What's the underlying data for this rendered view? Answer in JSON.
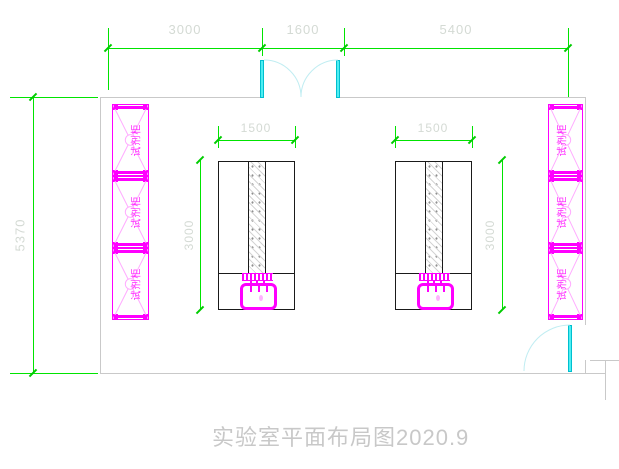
{
  "title": "实验室平面布局图2020.9",
  "dimensions": {
    "top_segments": [
      "3000",
      "1600",
      "5400"
    ],
    "room_height": "5370",
    "bench_width": "1500",
    "bench_depth": "3000"
  },
  "cabinets": {
    "left": [
      "试剂柜",
      "试剂柜",
      "试剂柜"
    ],
    "right": [
      "试剂柜",
      "试剂柜",
      "试剂柜"
    ]
  },
  "colors": {
    "dimension_line": "#00e400",
    "dimension_text": "#d4dad4",
    "cabinet": "#ff00ff",
    "door": "#4deef2",
    "wall": "#c9c9c9",
    "bench_outline": "#1a1a1a",
    "title_text": "#c8c8c8"
  }
}
